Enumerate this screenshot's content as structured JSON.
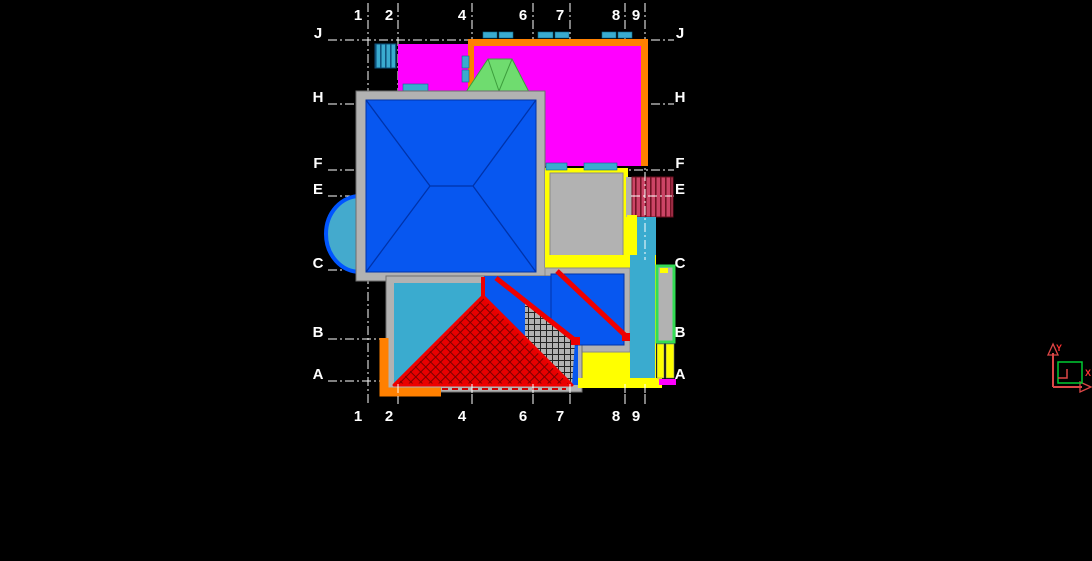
{
  "app": {
    "kind": "cad-viewport",
    "background": "#000000"
  },
  "grid": {
    "line_color": "#ffffff",
    "label_color": "#ffffff",
    "columns": [
      {
        "label": "1"
      },
      {
        "label": "2"
      },
      {
        "label": "4"
      },
      {
        "label": "6"
      },
      {
        "label": "7"
      },
      {
        "label": "8"
      },
      {
        "label": "9"
      }
    ],
    "rows": [
      {
        "label": "J"
      },
      {
        "label": "H"
      },
      {
        "label": "F"
      },
      {
        "label": "E"
      },
      {
        "label": "C"
      },
      {
        "label": "B"
      },
      {
        "label": "A"
      }
    ]
  },
  "ucs": {
    "x_label": "X",
    "y_label": "Y",
    "axis_color": "#DD4747",
    "plane_color": "#00CC33"
  },
  "colors": {
    "magenta_roof": "#FF00FF",
    "orange_trim": "#FF8000",
    "turquoise": "#3AABCF",
    "roof_blue": "#0757F0",
    "plate_gray": "#B2B2B2",
    "yellow": "#FFFF00",
    "red": "#EE0000",
    "crimson_hatch": "#CC4466",
    "light_green": "#6FDC6F",
    "bright_green": "#33DD55",
    "bay_border_blue": "#0055FF"
  }
}
